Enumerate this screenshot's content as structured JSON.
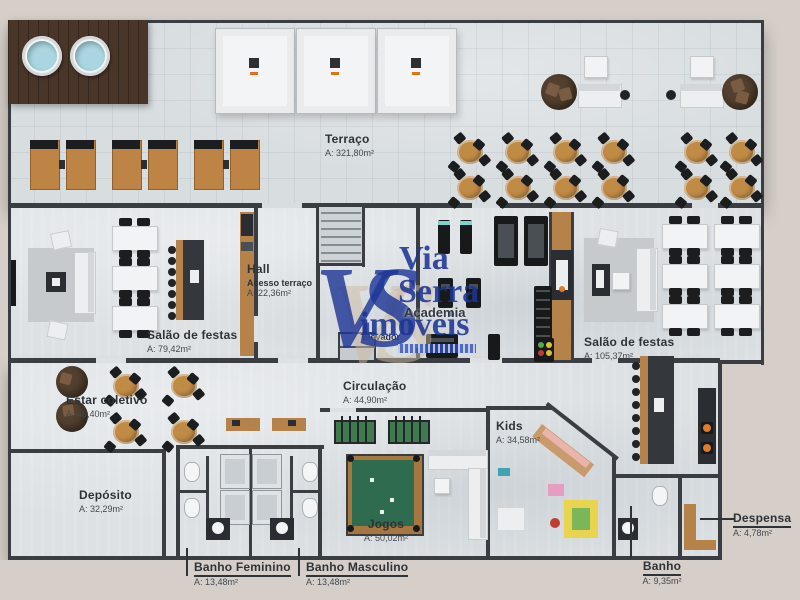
{
  "watermark": {
    "monogram": "VS",
    "line1": "Via",
    "line2": "Serra",
    "line3": "imóveis"
  },
  "rooms": {
    "terraco": {
      "name": "Terraço",
      "area": "A: 321,80m²"
    },
    "hall": {
      "name": "Hall",
      "subtitle": "Acesso terraço",
      "area": "A: 22,36m²"
    },
    "salao1": {
      "name": "Salão de festas",
      "area": "A: 79,42m²"
    },
    "salao2": {
      "name": "Salão de festas",
      "area": "A: 105,37m²"
    },
    "estar": {
      "name": "Estar coletivo",
      "area": "A: 46,40m²"
    },
    "circulacao": {
      "name": "Circulação",
      "area": "A: 44,90m²"
    },
    "deposito": {
      "name": "Depósito",
      "area": "A: 32,29m²"
    },
    "academia": {
      "name": "Academia"
    },
    "elevador": {
      "name": "Elevador"
    },
    "kids": {
      "name": "Kids",
      "area": "A: 34,58m²"
    },
    "jogos": {
      "name": "Jogos",
      "area": "A: 50,02m²"
    },
    "banho_fem": {
      "name": "Banho Feminino",
      "area": "A: 13,48m²"
    },
    "banho_masc": {
      "name": "Banho Masculino",
      "area": "A: 13,48m²"
    },
    "banho": {
      "name": "Banho",
      "area": "A: 9,35m²"
    },
    "despensa": {
      "name": "Despensa",
      "area": "A: 4,78m²"
    }
  },
  "colors": {
    "background": "#d6cfc9",
    "floor": "#dde1e4",
    "terrace_floor": "#d8dde0",
    "wall": "#3a3e43",
    "wood_deck": "#4a3529",
    "wood": "#b5824a",
    "water": "#a9d6e0",
    "pool_felt": "#2e6b4f",
    "watermark_blue": "#21409a",
    "label_text": "#2e3338",
    "accent_orange": "#e0701e"
  }
}
